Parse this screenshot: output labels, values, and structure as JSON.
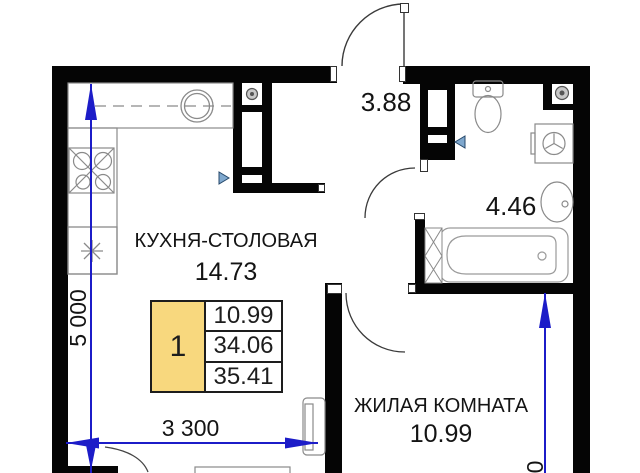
{
  "rooms": {
    "kitchen": {
      "name": "КУХНЯ-СТОЛОВАЯ",
      "area": "14.73"
    },
    "living_room": {
      "name": "ЖИЛАЯ КОМНАТА",
      "area": "10.99"
    },
    "hallway": {
      "area": "3.88"
    },
    "bathroom": {
      "area": "4.46"
    }
  },
  "apartment_card": {
    "rooms_count": "1",
    "areas": [
      "10.99",
      "34.06",
      "35.41"
    ]
  },
  "dimensions": {
    "bottom_width": "3 300",
    "left_height": "5 000",
    "right_height_partial": "0"
  },
  "icons": {
    "kitchen_sink": "double circle",
    "stove_burners": "square with 4 burner circles and diagonals",
    "appliance_star": "8-point asterisk burst",
    "vent_grille": "concentric circles in wall box",
    "toilet": "tank and bowl",
    "washing_machine": "square with drum circle",
    "bathtub": "rounded tub with drain",
    "wash_basin": "oval with tap dot",
    "direction_marker": "small blue triangle"
  },
  "colors": {
    "walls": "#050505",
    "dimension_lines": "#1C1CC8",
    "card_highlight": "#F8D87E",
    "marker_fill": "#7FA8CE",
    "fixtures": "#8A8A8A"
  }
}
